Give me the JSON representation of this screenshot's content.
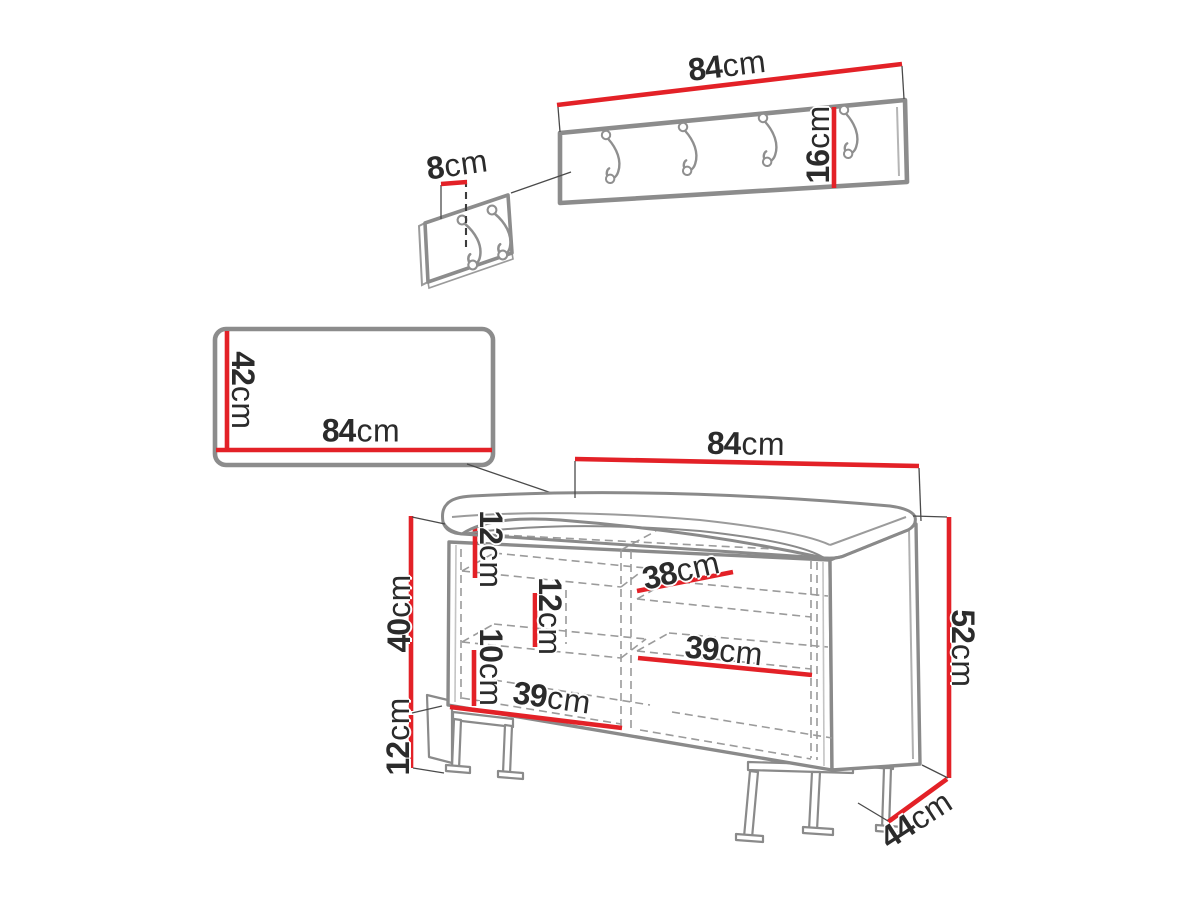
{
  "meta": {
    "type": "furniture-dimension-diagram",
    "unit": "cm",
    "background_color": "#ffffff",
    "accent_color": "#e32127",
    "outline_color": "#8c8c8c",
    "dashed_color": "#9b9b9b",
    "text_color": "#2b2b2b"
  },
  "figures": {
    "wall_rack": {
      "hooks": 4
    },
    "detail_panel": {
      "hooks": 2
    },
    "mirror_panel": {},
    "bench": {
      "compartments": 2,
      "legs": "metal sled"
    }
  },
  "dimensions": {
    "rack_width": {
      "value": "84",
      "unit": "cm"
    },
    "rack_height": {
      "value": "16",
      "unit": "cm"
    },
    "rack_hook_offset": {
      "value": "8",
      "unit": "cm"
    },
    "mirror_height": {
      "value": "42",
      "unit": "cm"
    },
    "mirror_width": {
      "value": "84",
      "unit": "cm"
    },
    "bench_width": {
      "value": "84",
      "unit": "cm"
    },
    "bench_total_height": {
      "value": "52",
      "unit": "cm"
    },
    "bench_depth": {
      "value": "44",
      "unit": "cm"
    },
    "bench_body_height": {
      "value": "40",
      "unit": "cm"
    },
    "bench_leg_height": {
      "value": "12",
      "unit": "cm"
    },
    "shelf_gap_top": {
      "value": "12",
      "unit": "cm"
    },
    "shelf_gap_middle": {
      "value": "12",
      "unit": "cm"
    },
    "shelf_gap_bottom": {
      "value": "10",
      "unit": "cm"
    },
    "interior_depth": {
      "value": "38",
      "unit": "cm"
    },
    "compartment_right_width": {
      "value": "39",
      "unit": "cm"
    },
    "compartment_left_width": {
      "value": "39",
      "unit": "cm"
    }
  }
}
